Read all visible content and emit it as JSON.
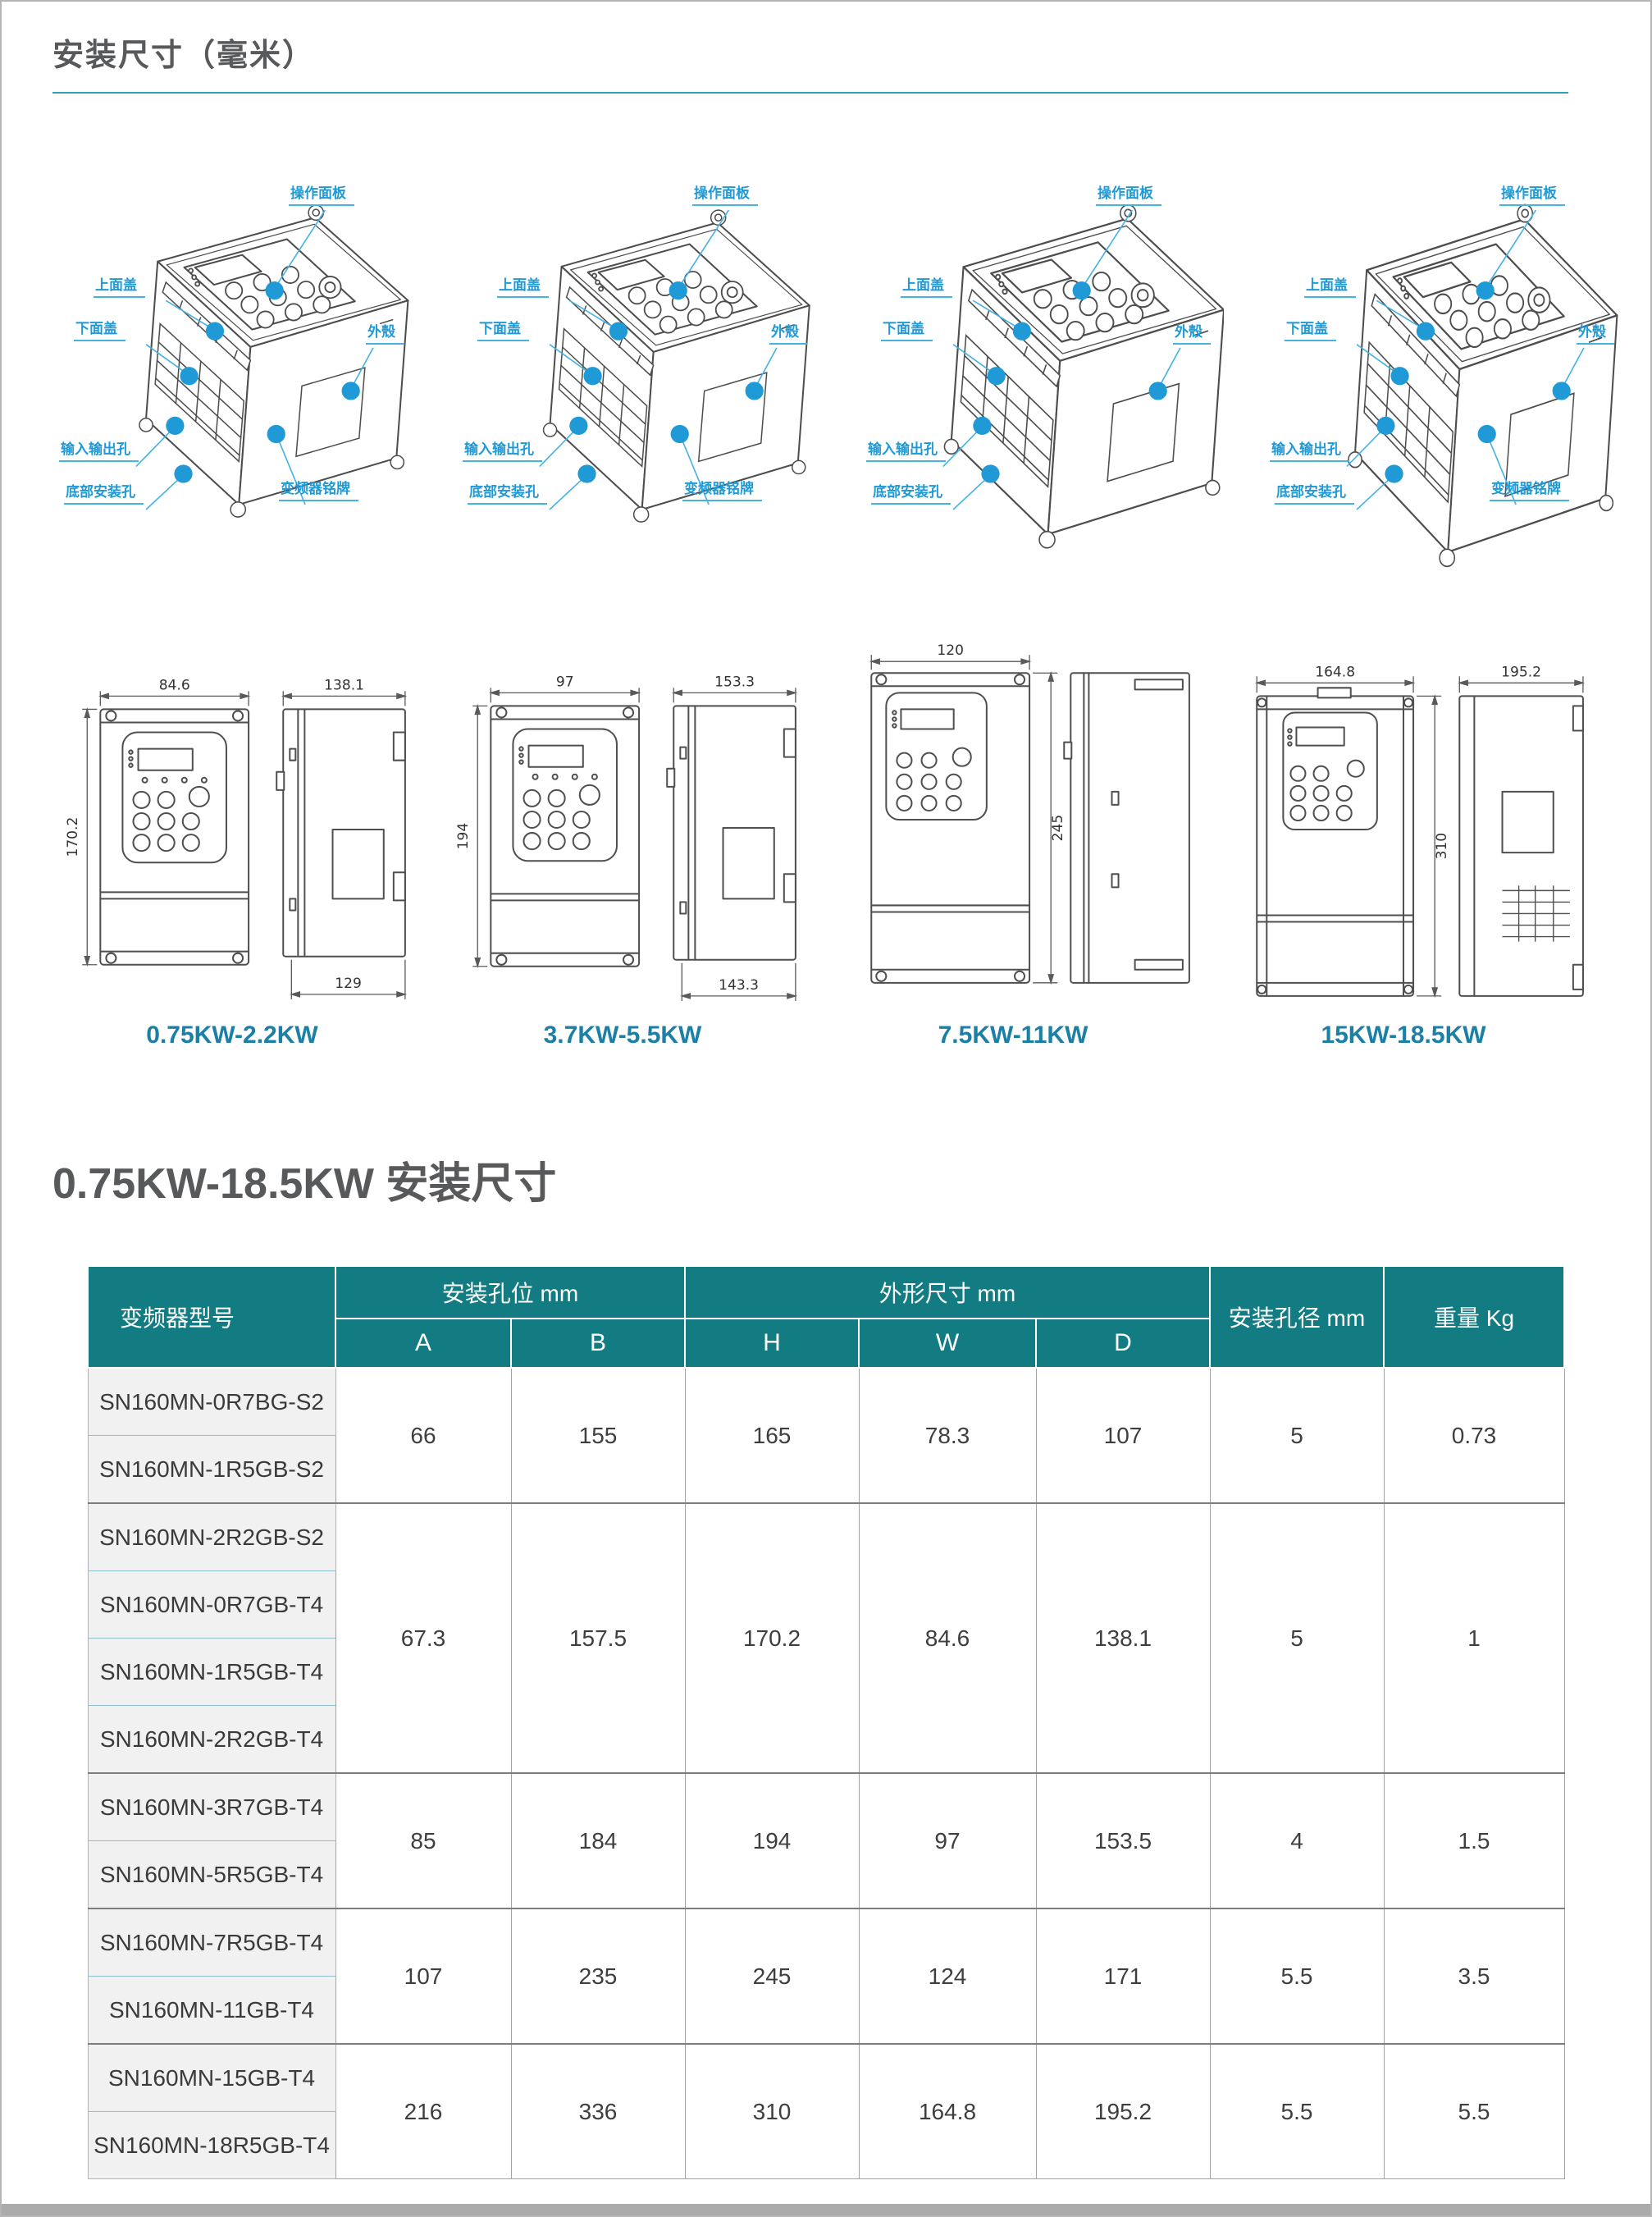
{
  "page": {
    "title": "安装尺寸（毫米）",
    "section2": "0.75KW-18.5KW 安装尺寸"
  },
  "colors": {
    "header-teal": "#137c82",
    "callout-blue": "#1f9ad6",
    "caption-teal": "#1b7fa6",
    "rule-teal": "#2fa3b5"
  },
  "callouts": {
    "panel": "操作面板",
    "top_cover": "上面盖",
    "bottom_cover": "下面盖",
    "shell": "外殼",
    "io_holes": "输入输出孔",
    "bottom_mount": "底部安装孔",
    "nameplate": "变频器铭牌"
  },
  "dims": [
    {
      "label": "0.75KW-2.2KW",
      "front_width": "84.6",
      "front_height": "170.2",
      "side_width": "138.1",
      "side_bottom": "129"
    },
    {
      "label": "3.7KW-5.5KW",
      "front_width": "97",
      "front_height": "194",
      "side_width": "153.3",
      "side_bottom": "143.3"
    },
    {
      "label": "7.5KW-11KW",
      "front_width": "120",
      "front_height": "245"
    },
    {
      "label": "15KW-18.5KW",
      "front_width": "164.8",
      "front_height": "310",
      "side_width": "195.2"
    }
  ],
  "table": {
    "col_model": "变频器型号",
    "group_mount": "安装孔位 mm",
    "group_outline": "外形尺寸 mm",
    "col_hole": "安装孔径 mm",
    "col_weight": "重量 Kg",
    "sub_cols": [
      "A",
      "B",
      "H",
      "W",
      "D"
    ],
    "groups": [
      {
        "models": [
          "SN160MN-0R7BG-S2",
          "SN160MN-1R5GB-S2"
        ],
        "A": "66",
        "B": "155",
        "H": "165",
        "W": "78.3",
        "D": "107",
        "hole": "5",
        "weight": "0.73"
      },
      {
        "models": [
          "SN160MN-2R2GB-S2",
          "SN160MN-0R7GB-T4",
          "SN160MN-1R5GB-T4",
          "SN160MN-2R2GB-T4"
        ],
        "A": "67.3",
        "B": "157.5",
        "H": "170.2",
        "W": "84.6",
        "D": "138.1",
        "hole": "5",
        "weight": "1"
      },
      {
        "models": [
          "SN160MN-3R7GB-T4",
          "SN160MN-5R5GB-T4"
        ],
        "A": "85",
        "B": "184",
        "H": "194",
        "W": "97",
        "D": "153.5",
        "hole": "4",
        "weight": "1.5"
      },
      {
        "models": [
          "SN160MN-7R5GB-T4",
          "SN160MN-11GB-T4"
        ],
        "A": "107",
        "B": "235",
        "H": "245",
        "W": "124",
        "D": "171",
        "hole": "5.5",
        "weight": "3.5"
      },
      {
        "models": [
          "SN160MN-15GB-T4",
          "SN160MN-18R5GB-T4"
        ],
        "A": "216",
        "B": "336",
        "H": "310",
        "W": "164.8",
        "D": "195.2",
        "hole": "5.5",
        "weight": "5.5"
      }
    ]
  }
}
